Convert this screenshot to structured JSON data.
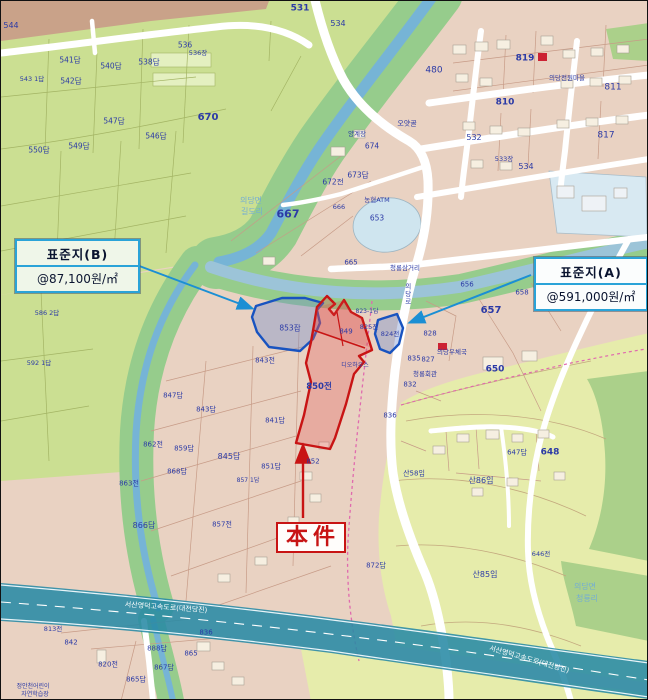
{
  "callouts": {
    "b": {
      "title": "표준지(B)",
      "value": "@87,100원/㎡"
    },
    "a": {
      "title": "표준지(A)",
      "value": "@591,000원/㎡"
    }
  },
  "subject": {
    "label": "本件",
    "parcel": "850전"
  },
  "highways": {
    "expressway_name": "서산영덕고속도로(대전당진)"
  },
  "colors": {
    "label_navy": "#2b3aa6",
    "place_blue": "#74aed2",
    "highlight_red": "#c81414",
    "highlight_blue": "#1853c0",
    "callout_border": "#2aa3d8",
    "water_blue": "#76b4d6",
    "expressway_teal": "#2a8aa5",
    "farmland_green": "#cbdf92",
    "urban_tan": "#e9d2c2",
    "forest_green": "#abd08a",
    "hill_yellow": "#e6ecab"
  },
  "map_labels": [
    {
      "t": "531",
      "x": 299,
      "y": 8,
      "s": 9,
      "b": 1
    },
    {
      "t": "534",
      "x": 337,
      "y": 23,
      "s": 8
    },
    {
      "t": "544",
      "x": 10,
      "y": 25,
      "s": 8
    },
    {
      "t": "543 1답",
      "x": 31,
      "y": 78,
      "s": 6.5
    },
    {
      "t": "541답",
      "x": 69,
      "y": 59,
      "s": 7.5
    },
    {
      "t": "542답",
      "x": 70,
      "y": 80,
      "s": 7.5
    },
    {
      "t": "540답",
      "x": 110,
      "y": 65,
      "s": 7.5
    },
    {
      "t": "538답",
      "x": 148,
      "y": 61,
      "s": 7.5
    },
    {
      "t": "536",
      "x": 184,
      "y": 44,
      "s": 7.5
    },
    {
      "t": "536장",
      "x": 197,
      "y": 52,
      "s": 6.5
    },
    {
      "t": "547답",
      "x": 113,
      "y": 120,
      "s": 7.5
    },
    {
      "t": "546답",
      "x": 155,
      "y": 135,
      "s": 7.5
    },
    {
      "t": "549답",
      "x": 78,
      "y": 145,
      "s": 7.5
    },
    {
      "t": "550답",
      "x": 38,
      "y": 149,
      "s": 7.5
    },
    {
      "t": "670",
      "x": 207,
      "y": 117,
      "s": 10,
      "b": 1
    },
    {
      "t": "586 2답",
      "x": 46,
      "y": 312,
      "s": 6.5
    },
    {
      "t": "592 1답",
      "x": 38,
      "y": 362,
      "s": 6.5
    },
    {
      "t": "480",
      "x": 433,
      "y": 70,
      "s": 9
    },
    {
      "t": "819",
      "x": 524,
      "y": 58,
      "s": 9,
      "b": 1
    },
    {
      "t": "811",
      "x": 612,
      "y": 87,
      "s": 9
    },
    {
      "t": "810",
      "x": 504,
      "y": 102,
      "s": 9,
      "b": 1
    },
    {
      "t": "817",
      "x": 605,
      "y": 135,
      "s": 9
    },
    {
      "t": "의당전원마을",
      "x": 566,
      "y": 77,
      "s": 6.5
    },
    {
      "t": "532",
      "x": 473,
      "y": 137,
      "s": 8
    },
    {
      "t": "533장",
      "x": 503,
      "y": 158,
      "s": 6.5
    },
    {
      "t": "534",
      "x": 525,
      "y": 166,
      "s": 8
    },
    {
      "t": "667",
      "x": 287,
      "y": 213,
      "s": 11,
      "b": 1
    },
    {
      "t": "672전",
      "x": 332,
      "y": 181,
      "s": 7.5
    },
    {
      "t": "673답",
      "x": 357,
      "y": 174,
      "s": 7.5
    },
    {
      "t": "674",
      "x": 371,
      "y": 145,
      "s": 7.5
    },
    {
      "t": "오얏골",
      "x": 406,
      "y": 123,
      "s": 7
    },
    {
      "t": "양계장",
      "x": 356,
      "y": 133,
      "s": 6.5
    },
    {
      "t": "농협ATM",
      "x": 376,
      "y": 199,
      "s": 6.5
    },
    {
      "t": "653",
      "x": 376,
      "y": 217,
      "s": 7.5
    },
    {
      "t": "666",
      "x": 338,
      "y": 206,
      "s": 6.5
    },
    {
      "t": "665",
      "x": 350,
      "y": 262,
      "s": 7
    },
    {
      "t": "청룡삼거리",
      "x": 404,
      "y": 267,
      "s": 6.5
    },
    {
      "t": "의당로",
      "x": 406,
      "y": 293,
      "s": 6.5,
      "v": 1
    },
    {
      "t": "656",
      "x": 466,
      "y": 284,
      "s": 7
    },
    {
      "t": "657",
      "x": 490,
      "y": 310,
      "s": 10,
      "b": 1
    },
    {
      "t": "658",
      "x": 521,
      "y": 292,
      "s": 7
    },
    {
      "t": "823-1답",
      "x": 366,
      "y": 311,
      "s": 6
    },
    {
      "t": "825전",
      "x": 368,
      "y": 326,
      "s": 6.5
    },
    {
      "t": "824전",
      "x": 389,
      "y": 333,
      "s": 6.5
    },
    {
      "t": "853잡",
      "x": 289,
      "y": 327,
      "s": 7.5
    },
    {
      "t": "849",
      "x": 345,
      "y": 331,
      "s": 7
    },
    {
      "t": "850전",
      "x": 318,
      "y": 386,
      "s": 8.5,
      "b": 1
    },
    {
      "t": "디오하우스",
      "x": 354,
      "y": 365,
      "s": 6
    },
    {
      "t": "835",
      "x": 413,
      "y": 358,
      "s": 7
    },
    {
      "t": "832",
      "x": 409,
      "y": 384,
      "s": 7
    },
    {
      "t": "836",
      "x": 389,
      "y": 415,
      "s": 7
    },
    {
      "t": "828",
      "x": 429,
      "y": 333,
      "s": 7
    },
    {
      "t": "827",
      "x": 427,
      "y": 359,
      "s": 7
    },
    {
      "t": "의당우체국",
      "x": 451,
      "y": 351,
      "s": 6.5
    },
    {
      "t": "청룡회관",
      "x": 424,
      "y": 373,
      "s": 6.5
    },
    {
      "t": "650",
      "x": 494,
      "y": 369,
      "s": 9,
      "b": 1
    },
    {
      "t": "843전",
      "x": 264,
      "y": 360,
      "s": 7
    },
    {
      "t": "841답",
      "x": 274,
      "y": 420,
      "s": 7
    },
    {
      "t": "847답",
      "x": 172,
      "y": 395,
      "s": 7
    },
    {
      "t": "843답",
      "x": 205,
      "y": 409,
      "s": 7
    },
    {
      "t": "845답",
      "x": 228,
      "y": 456,
      "s": 8
    },
    {
      "t": "862전",
      "x": 152,
      "y": 444,
      "s": 7
    },
    {
      "t": "859답",
      "x": 183,
      "y": 448,
      "s": 7
    },
    {
      "t": "868답",
      "x": 176,
      "y": 471,
      "s": 7
    },
    {
      "t": "863전",
      "x": 128,
      "y": 483,
      "s": 7
    },
    {
      "t": "851답",
      "x": 270,
      "y": 466,
      "s": 7
    },
    {
      "t": "857 1답",
      "x": 247,
      "y": 480,
      "s": 6
    },
    {
      "t": "866답",
      "x": 143,
      "y": 525,
      "s": 8
    },
    {
      "t": "857전",
      "x": 221,
      "y": 524,
      "s": 7
    },
    {
      "t": "852",
      "x": 312,
      "y": 461,
      "s": 7
    },
    {
      "t": "872답",
      "x": 375,
      "y": 565,
      "s": 7
    },
    {
      "t": "산58임",
      "x": 413,
      "y": 473,
      "s": 7
    },
    {
      "t": "산86임",
      "x": 480,
      "y": 480,
      "s": 8
    },
    {
      "t": "산85임",
      "x": 484,
      "y": 574,
      "s": 8
    },
    {
      "t": "647답",
      "x": 516,
      "y": 452,
      "s": 7
    },
    {
      "t": "648",
      "x": 549,
      "y": 452,
      "s": 9,
      "b": 1
    },
    {
      "t": "646전",
      "x": 540,
      "y": 553,
      "s": 6.5
    },
    {
      "t": "의당면",
      "x": 250,
      "y": 200,
      "s": 8,
      "c": "#74aed2"
    },
    {
      "t": "길도리",
      "x": 251,
      "y": 211,
      "s": 8,
      "c": "#74aed2"
    },
    {
      "t": "의당면",
      "x": 584,
      "y": 586,
      "s": 8,
      "c": "#74aed2"
    },
    {
      "t": "청룡리",
      "x": 586,
      "y": 598,
      "s": 8,
      "c": "#74aed2"
    },
    {
      "t": "813전",
      "x": 52,
      "y": 628,
      "s": 6.5
    },
    {
      "t": "842",
      "x": 70,
      "y": 642,
      "s": 7
    },
    {
      "t": "820전",
      "x": 107,
      "y": 664,
      "s": 7
    },
    {
      "t": "888답",
      "x": 156,
      "y": 648,
      "s": 7
    },
    {
      "t": "865",
      "x": 190,
      "y": 653,
      "s": 7
    },
    {
      "t": "867답",
      "x": 163,
      "y": 667,
      "s": 7
    },
    {
      "t": "865답",
      "x": 135,
      "y": 679,
      "s": 7
    },
    {
      "t": "836",
      "x": 205,
      "y": 632,
      "s": 7
    },
    {
      "t": "정안천어린이",
      "x": 32,
      "y": 686,
      "s": 6
    },
    {
      "t": "자연학습장",
      "x": 34,
      "y": 694,
      "s": 6
    },
    {
      "t": "서산영덕고속도로(대전당진)",
      "x": 165,
      "y": 607,
      "s": 7,
      "c": "#ffffff",
      "r": 4
    },
    {
      "t": "서산영덕고속도로(대전당진)",
      "x": 528,
      "y": 659,
      "s": 7,
      "c": "#ffffff",
      "r": 16
    }
  ]
}
